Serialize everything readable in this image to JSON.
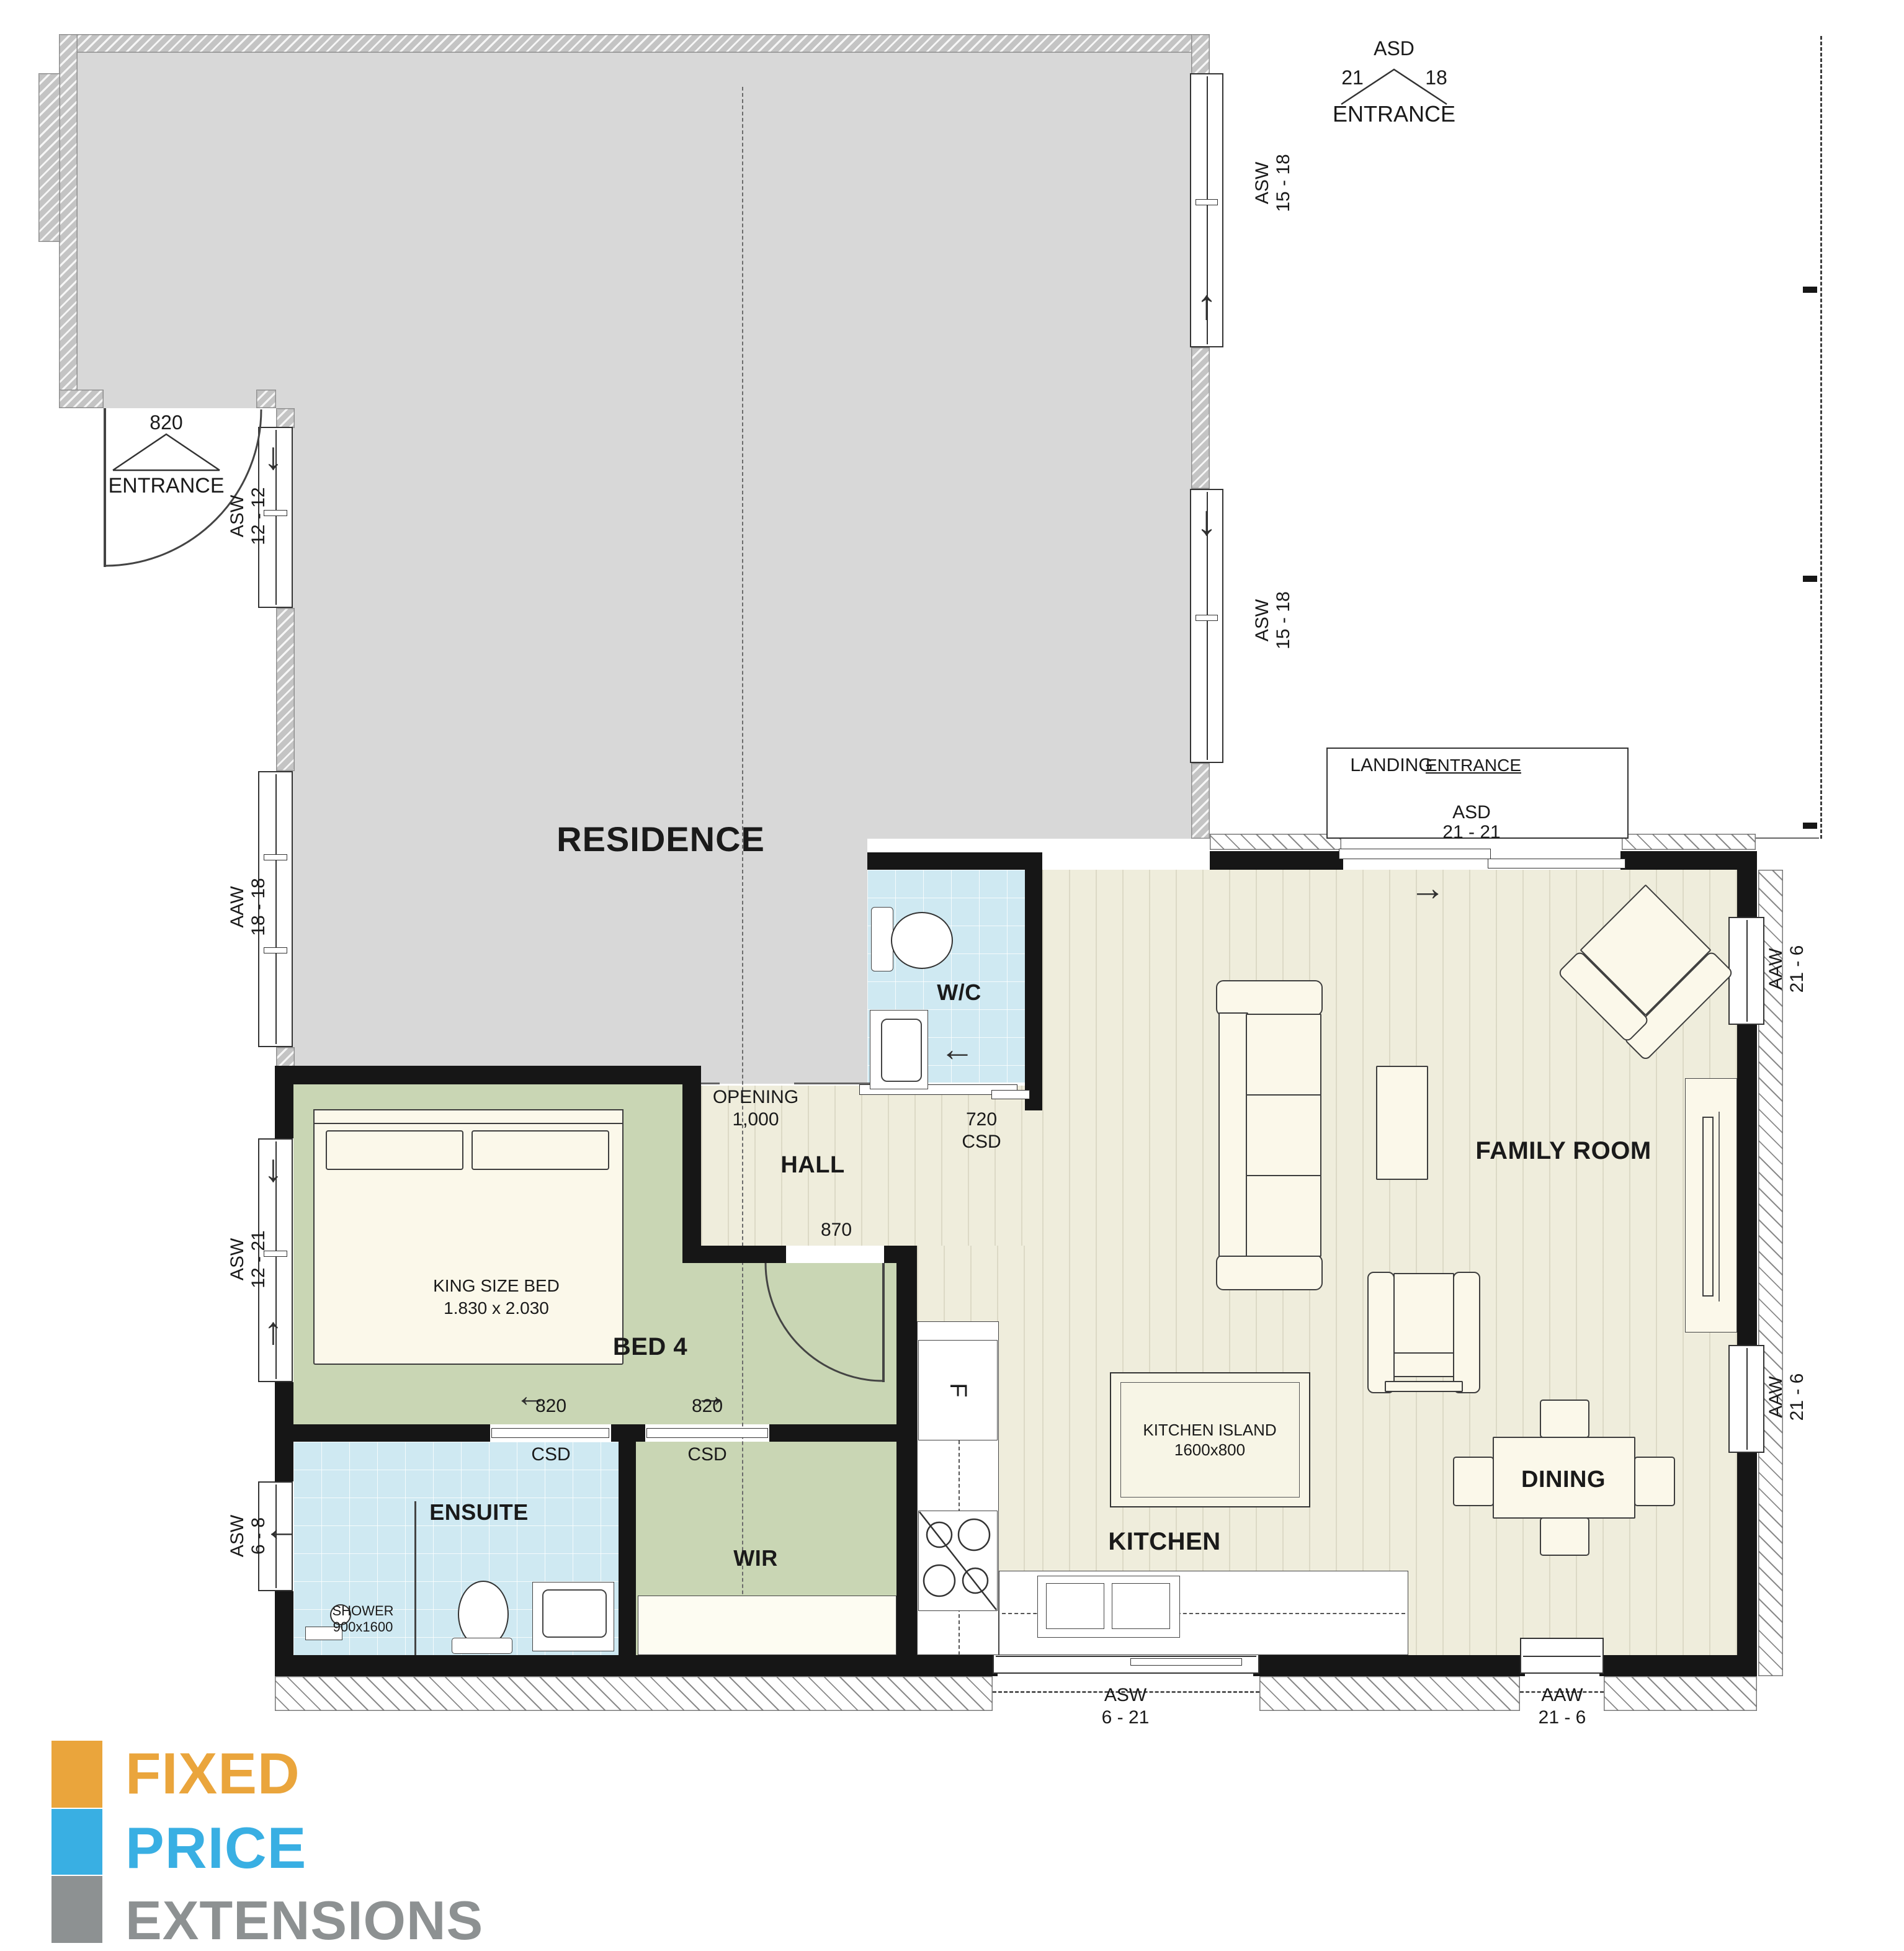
{
  "residence": {
    "label": "RESIDENCE"
  },
  "entrance_existing_top": {
    "code": "ASD",
    "dim_left": "21",
    "dim_right": "18",
    "label": "ENTRANCE"
  },
  "entrance_existing_left": {
    "size": "820",
    "label": "ENTRANCE"
  },
  "landing": {
    "label": "LANDING",
    "entrance_label": "ENTRANCE",
    "code": "ASD",
    "size": "21 - 21"
  },
  "rooms": {
    "wc": "W/C",
    "hall": "HALL",
    "bed4": "BED 4",
    "ensuite": "ENSUITE",
    "wir": "WIR",
    "kitchen": "KITCHEN",
    "dining": "DINING",
    "family": "FAMILY ROOM"
  },
  "windows": {
    "asw1518_upper": {
      "code": "ASW",
      "size": "15 - 18"
    },
    "asw1518_lower": {
      "code": "ASW",
      "size": "15 - 18"
    },
    "asw1212": {
      "code": "ASW",
      "size": "12 - 12"
    },
    "aaw1818": {
      "code": "AAW",
      "size": "18 - 18"
    },
    "asw1221": {
      "code": "ASW",
      "size": "12 - 21"
    },
    "asw68": {
      "code": "ASW",
      "size": "6 - 8"
    },
    "asw621_bottom": {
      "code": "ASW",
      "size": "6 - 21"
    },
    "aaw216_bottom": {
      "code": "AAW",
      "size": "21 - 6"
    },
    "aaw216_right_top": {
      "code": "AAW",
      "size": "21 - 6"
    },
    "aaw216_right_bottom": {
      "code": "AAW",
      "size": "21 - 6"
    }
  },
  "doors": {
    "wc_slider": {
      "size": "720",
      "type": "CSD"
    },
    "bed_slider": {
      "size": "820",
      "type": "CSD"
    },
    "wir_slider": {
      "size": "820",
      "type": "CSD"
    },
    "hall_swing": {
      "size": "870"
    },
    "opening": {
      "line1": "OPENING",
      "line2": "1,000"
    }
  },
  "fixtures": {
    "bed": {
      "line1": "KING SIZE BED",
      "line2": "1.830 x 2.030"
    },
    "island": {
      "line1": "KITCHEN ISLAND",
      "line2": "1600x800"
    },
    "shower": {
      "line1": "SHOWER",
      "line2": "900x1600"
    },
    "fridge": "F"
  },
  "icons": {
    "arrow_left": "←",
    "arrow_right": "→",
    "arrow_up": "↑",
    "arrow_down": "↓"
  },
  "logo": {
    "line1": "FIXED",
    "line2": "PRICE",
    "line3": "EXTENSIONS",
    "colors": {
      "orange": "#EAA53C",
      "blue": "#39AFE3",
      "gray": "#8D9192"
    }
  },
  "floor_colors": {
    "cream": "#efeddc",
    "green": "#c9d6b4",
    "tile_blue": "#cfe9f2",
    "residence_gray": "#d8d8d8"
  }
}
